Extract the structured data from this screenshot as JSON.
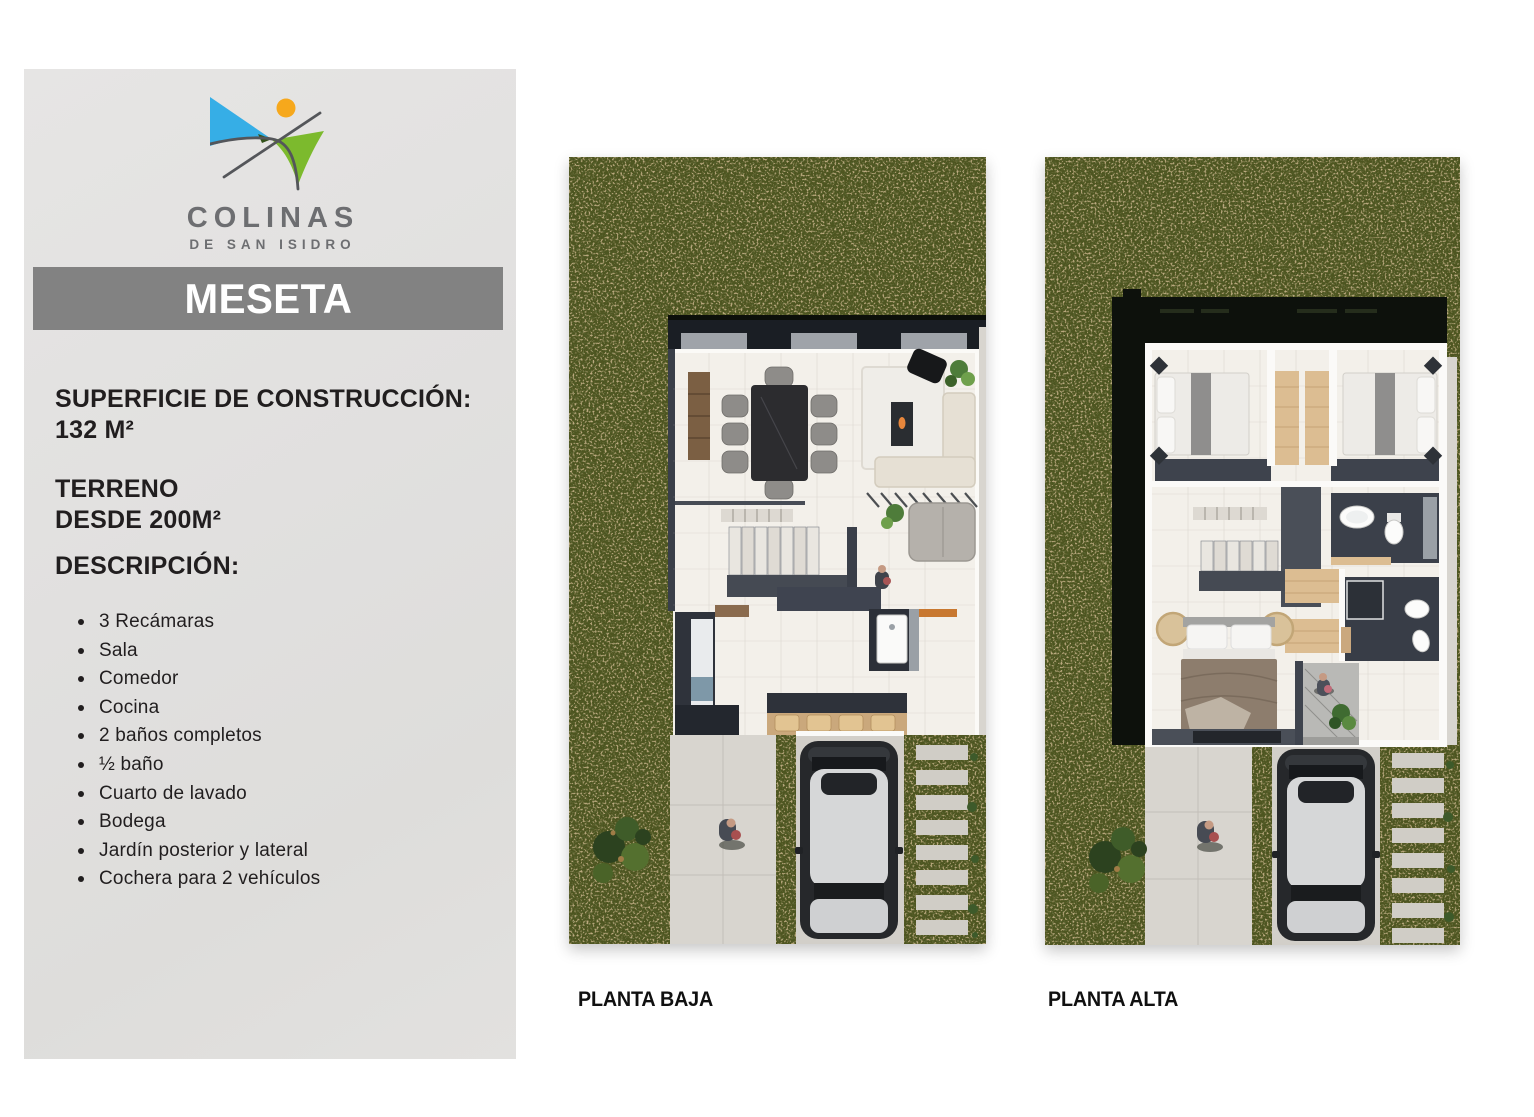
{
  "sidebar": {
    "background": "#e1e0df",
    "logo": {
      "brand_line1": "COLINAS",
      "brand_line2": "DE SAN ISIDRO",
      "colors": {
        "blue": "#36aee6",
        "green": "#7cba2d",
        "dark_green": "#33511a",
        "orange": "#f6a81c",
        "line_gray": "#54565a",
        "text_gray": "#6d6e71"
      }
    },
    "banner": {
      "label": "MESETA",
      "background": "#828282",
      "text_color": "#ffffff"
    },
    "specs": {
      "construction_label": "SUPERFICIE DE CONSTRUCCIÓN:",
      "construction_value": "132 M²",
      "land_label": "TERRENO",
      "land_value": "DESDE 200M²",
      "description_label": "DESCRIPCIÓN:"
    },
    "features": [
      "3 Recámaras",
      "Sala",
      "Comedor",
      "Cocina",
      "2 baños completos",
      "½ baño",
      "Cuarto de lavado",
      "Bodega",
      "Jardín posterior y lateral",
      "Cochera para 2 vehículos"
    ],
    "text_color": "#211e1f"
  },
  "plans": {
    "baja": {
      "label": "PLANTA BAJA"
    },
    "alta": {
      "label": "PLANTA ALTA"
    },
    "palette": {
      "grass": "#4d5520",
      "grass_speckle": "#9e7a47",
      "concrete": "#d3d0ca",
      "floor": "#f3f0ea",
      "wall_dark": "#3a3f49",
      "roof": "#0d110c",
      "wood": "#dcbd92",
      "car_body": "#26282b",
      "car_roof": "#d6d7d8"
    }
  }
}
